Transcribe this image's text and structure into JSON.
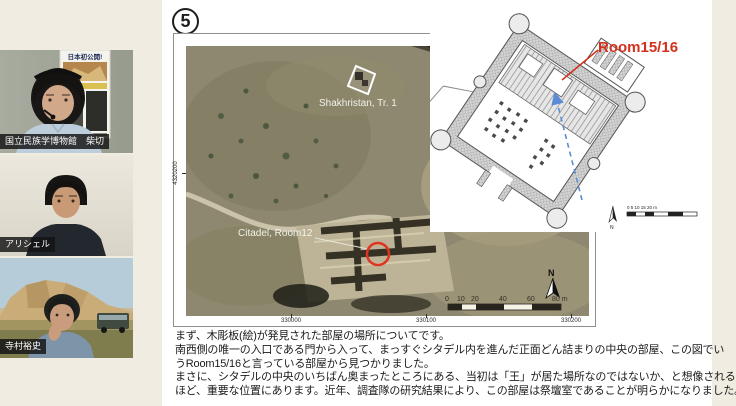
{
  "participants": [
    {
      "name": "国立民族学博物館　柴切"
    },
    {
      "name": "アリシェル"
    },
    {
      "name": "寺村裕史"
    }
  ],
  "poster": {
    "title": "日本初公開!"
  },
  "slide": {
    "number": "5",
    "satellite": {
      "label_shakhristan": "Shakhristan, Tr. 1",
      "label_citadel": "Citadel, Room12",
      "north_label": "N",
      "scale_ticks": [
        "0",
        "10",
        "20",
        "40",
        "60",
        "80 m"
      ],
      "coords_bottom": [
        "330000",
        "330100",
        "330200"
      ],
      "coord_left": "4320200"
    },
    "plan": {
      "room_label": "Room15/16",
      "north_label": "N",
      "scale_label": "0   5   10   15   20 m"
    },
    "body_lines": [
      "まず、木彫板(絵)が発見された部屋の場所についてです。",
      "南西側の唯一の入口である門から入って、まっすぐシタデル内を進んだ正面どん詰まりの中央の部屋、この図でい",
      "うRoom15/16と言っている部屋から見つかりました。",
      "まさに、シタデルの中央のいちばん奥まったところにある、当初は「王」が居た場所なのではないか、と想像される",
      "ほど、重要な位置にあります。近年、調査隊の研究結果により、この部屋は祭壇室であることが明らかになりました。"
    ]
  },
  "colors": {
    "accent_red": "#d4301c",
    "arrow_blue": "#5b8dd6"
  }
}
